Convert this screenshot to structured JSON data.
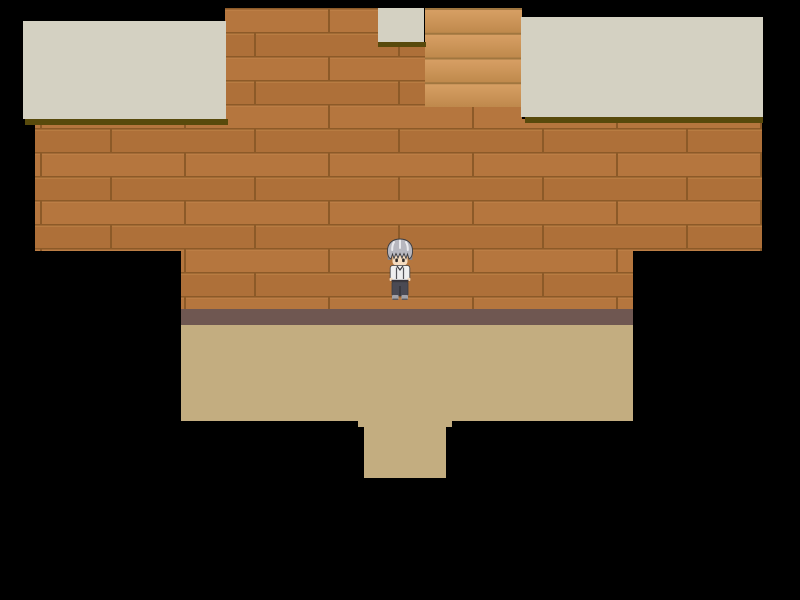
{
  "scene": {
    "type": "game-map",
    "view": "top-down interior room",
    "description": "Room with wooden plank wall, beige ceiling ledges, a staircase opening, tan floor with doorway notch, and one character standing at center facing down."
  },
  "colors": {
    "background": "#000000",
    "ceiling": "#d4d1c2",
    "ceiling_shadow": "#584a0c",
    "wall_row_a": "#b5763e",
    "wall_row_b": "#ae7039",
    "wall_line": "#8c5a28",
    "wall_highlight": "#c5894e",
    "stair_light": "#d9a166",
    "stair_dark": "#bf894c",
    "stair_line": "#a0763f",
    "baseboard": "#6f5751",
    "floor": "#c3ad80",
    "hair_light": "#efeff3",
    "hair_mid": "#b7b7bf",
    "hair_dark": "#84848c",
    "skin": "#f5dcc0",
    "eye": "#2e2a28",
    "shirt": "#efefef",
    "collar": "#3a3a40",
    "belt": "#35323a",
    "pants": "#4a4a54",
    "pants_dark": "#2e2e34",
    "shoes": "#a2a2a8",
    "sole": "#55555a",
    "outline": "#3c3c40"
  },
  "character": {
    "id": "player",
    "facing": "down",
    "hair": "silver-gray spiky",
    "outfit": "white shirt with dark suspenders, dark gray pants, gray shoes"
  }
}
